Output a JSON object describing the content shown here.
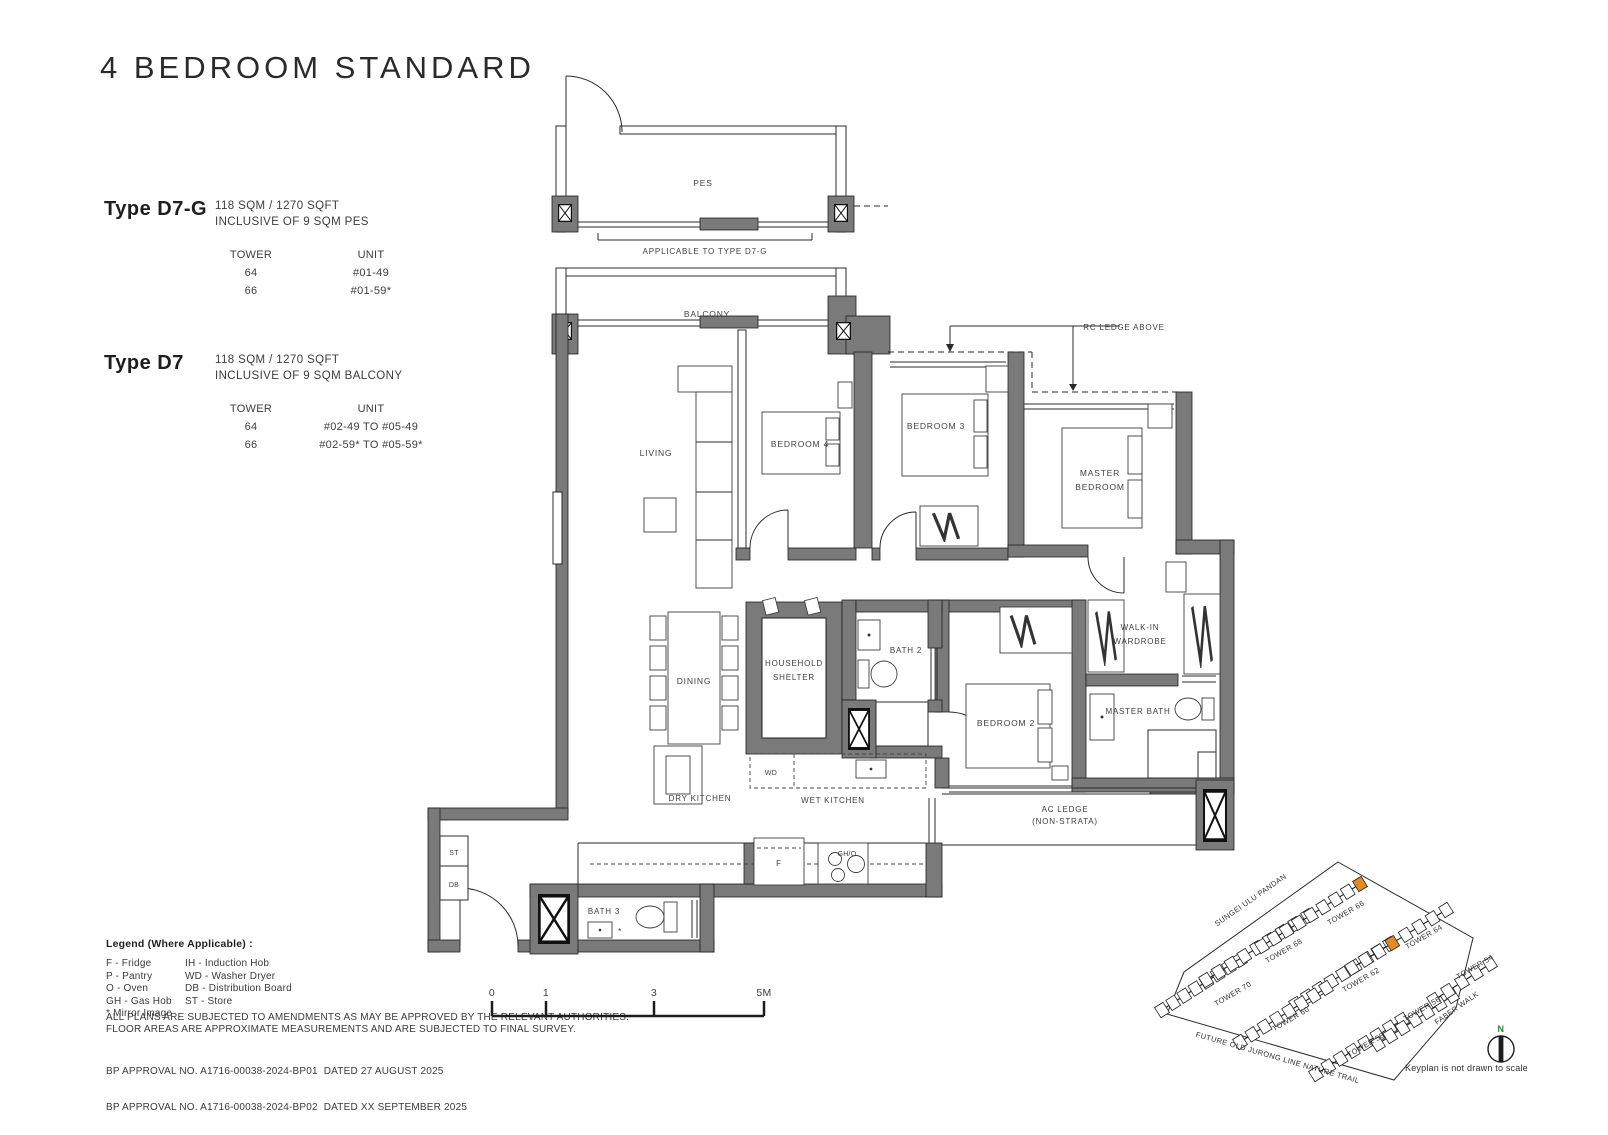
{
  "title": "4 BEDROOM STANDARD",
  "types": [
    {
      "name": "Type D7-G",
      "area": "118 SQM / 1270 SQFT",
      "inclusive": "INCLUSIVE OF 9 SQM PES",
      "tower_header": "TOWER",
      "unit_header": "UNIT",
      "rows": [
        {
          "tower": "64",
          "unit": "#01-49"
        },
        {
          "tower": "66",
          "unit": "#01-59*"
        }
      ]
    },
    {
      "name": "Type D7",
      "area": "118 SQM / 1270 SQFT",
      "inclusive": "INCLUSIVE OF 9 SQM BALCONY",
      "tower_header": "TOWER",
      "unit_header": "UNIT",
      "rows": [
        {
          "tower": "64",
          "unit": "#02-49 TO #05-49"
        },
        {
          "tower": "66",
          "unit": "#02-59* TO #05-59*"
        }
      ]
    }
  ],
  "plan": {
    "pes": "PES",
    "applicable": "APPLICABLE TO TYPE D7-G",
    "balcony": "BALCONY",
    "rc_ledge": "RC LEDGE ABOVE",
    "living": "LIVING",
    "dining": "DINING",
    "bedroom4": "BEDROOM 4",
    "bedroom3": "BEDROOM 3",
    "bedroom2": "BEDROOM 2",
    "master_line1": "MASTER",
    "master_line2": "BEDROOM",
    "hs_line1": "HOUSEHOLD",
    "hs_line2": "SHELTER",
    "bath2": "BATH 2",
    "bath3": "BATH 3",
    "wiw_line1": "WALK-IN",
    "wiw_line2": "WARDROBE",
    "master_bath": "MASTER BATH",
    "dry_kitchen": "DRY KITCHEN",
    "wet_kitchen": "WET KITCHEN",
    "ac_line1": "AC LEDGE",
    "ac_line2": "(NON-STRATA)",
    "st": "ST",
    "db": "DB",
    "wd": "WD",
    "fridge": "F",
    "hob": "GH/O",
    "mirror": "*"
  },
  "legend": {
    "title": "Legend (Where Applicable) :",
    "col1": [
      "F - Fridge",
      "P - Pantry",
      "O - Oven",
      "GH - Gas Hob",
      "* Mirror Image"
    ],
    "col2": [
      "IH - Induction Hob",
      "WD - Washer Dryer",
      "DB - Distribution Board",
      "ST - Store"
    ]
  },
  "notes": [
    "ALL PLANS ARE SUBJECTED TO AMENDMENTS AS MAY BE APPROVED BY THE RELEVANT AUTHORITIES.",
    "FLOOR AREAS ARE APPROXIMATE MEASUREMENTS AND ARE SUBJECTED TO FINAL SURVEY."
  ],
  "approvals": [
    "BP APPROVAL NO. A1716-00038-2024-BP01  DATED 27 AUGUST 2025",
    "BP APPROVAL NO. A1716-00038-2024-BP02  DATED XX SEPTEMBER 2025"
  ],
  "scalebar": [
    "0",
    "1",
    "3",
    "5M"
  ],
  "keyplan": {
    "streets": [
      "SUNGEI ULU PANDAN",
      "FABER WALK",
      "FUTURE OLD JURONG LINE NATURE TRAIL"
    ],
    "towers": [
      "TOWER 70",
      "TOWER 68",
      "TOWER 66",
      "TOWER 62",
      "TOWER 64",
      "TOWER 60",
      "TOWER 58",
      "TOWER 56",
      "TOWER 54"
    ],
    "north": "N",
    "note": "Keyplan is not drawn to scale",
    "highlight_color": "#E08A28"
  }
}
